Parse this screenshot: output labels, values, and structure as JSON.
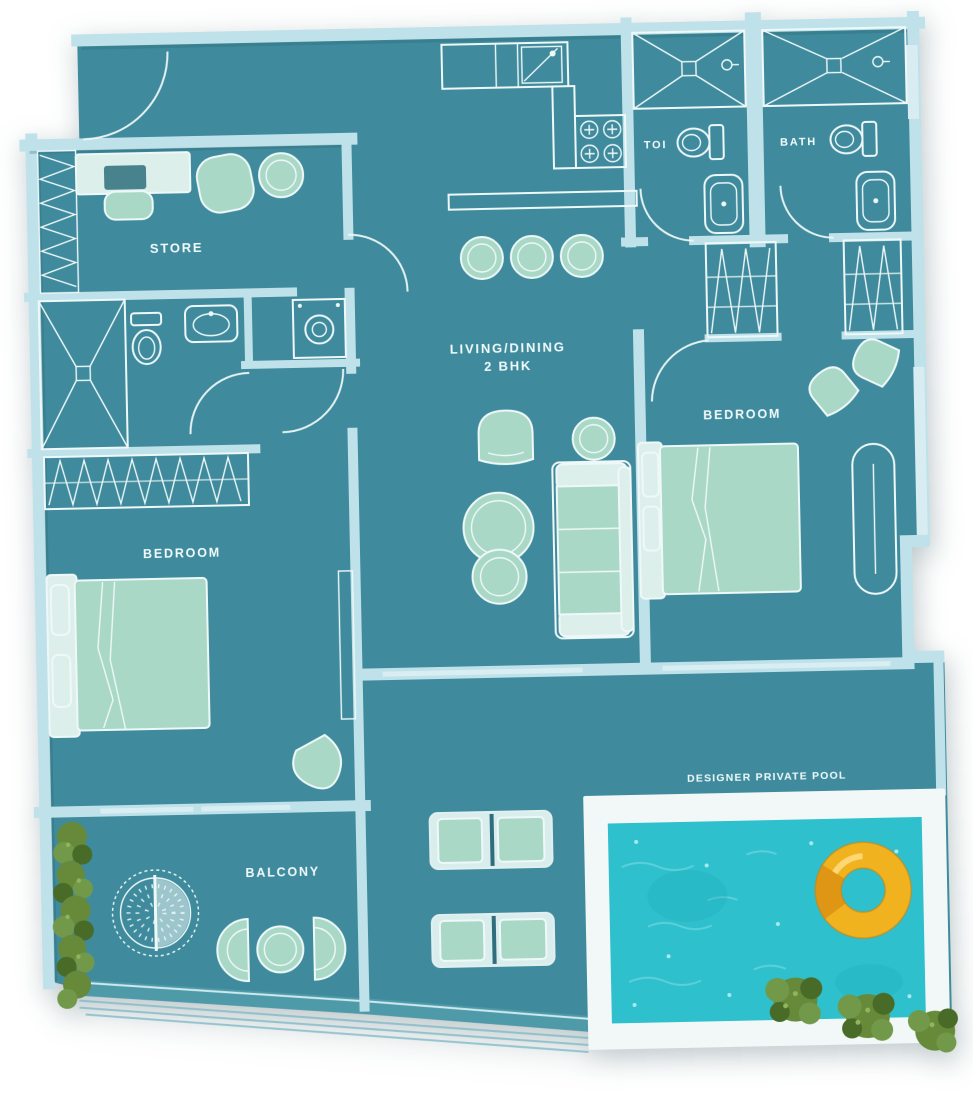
{
  "labels": {
    "store": "STORE",
    "toi": "TOI",
    "bath": "BATH",
    "living_dining_line1": "LIVING/DINING",
    "living_dining_line2": "2 BHK",
    "bedroom_right": "BEDROOM",
    "bedroom_left": "BEDROOM",
    "balcony": "BALCONY",
    "private_pool": "DESIGNER PRIVATE POOL"
  },
  "colors": {
    "floor": "#3f8b9d",
    "wall": "#bfe1e9",
    "wall_dark": "#4f9aa9",
    "outline": "#eef8f8",
    "furniture": "#a9d8c7",
    "furniture_light": "#dcefeb",
    "pool_water": "#2fc0cd",
    "pool_deck": "#f2f8f7",
    "float_yellow": "#f0b31f",
    "float_shade": "#d98f12",
    "plant_green": "#66893a",
    "label_text": "#f2fbfc",
    "page_background": "#ffffff"
  }
}
